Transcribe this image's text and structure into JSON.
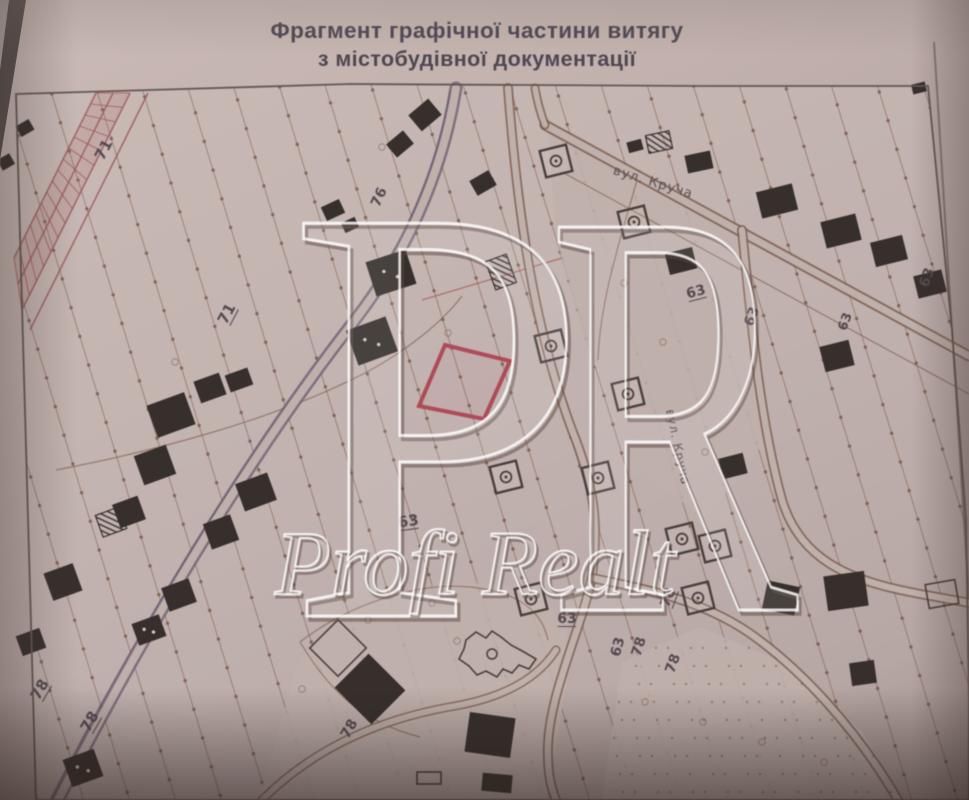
{
  "title": {
    "line1": "Фрагмент графічної частини витягу",
    "line2": "з містобудівної документації"
  },
  "watermark": {
    "letter_p": "P",
    "letter_r": "R",
    "name": "Profi Realt"
  },
  "colors": {
    "paper_map": "rgba(200,186,182,0.55)",
    "paper_solid": "#c0b0ac",
    "hatch_line": "rgba(125,88,70,0.55)",
    "hatch_dot": "rgba(100,64,48,0.6)",
    "boundary": "rgba(130,90,75,0.8)",
    "boundary_red": "rgba(168,82,80,0.85)",
    "road_edge": "#7a5a49",
    "road_main": "#6f5f74",
    "rail": "#a05a60",
    "rail_fill": "rgba(176,92,96,0.16)",
    "highlight": "#b34a58",
    "highlight_fill": "rgba(179,74,88,0.06)",
    "building": "#362f2b",
    "building_dot": "#d8ccc6",
    "symbol": "#4a3f3b",
    "label": "#554a52",
    "street": "#5b4f55",
    "frame": "#625854",
    "title": "#4d4753",
    "watermark_light": "rgba(255,255,255,0.82)",
    "watermark_dark": "rgba(92,72,64,0.5)",
    "watermark_fill": "rgba(240,236,238,0.10)",
    "dot_texture": "rgba(110,80,65,0.5)"
  },
  "map": {
    "frame": "16,94 350,84 700,86 928,86 952,330 966,520 969,700 969,800 36,800",
    "paper_edge": "M 934,42 C 948,240 958,420 969,600",
    "clear_regions": [
      "548,130 735,227 748,340 762,445 705,520 640,468 590,355 556,238",
      "258,800 300,658 362,602 452,582 540,587 572,642 560,722 546,800",
      "602,800 622,662 700,627 782,662 862,732 902,800"
    ],
    "rail_band": {
      "poly": "96,93 130,93 22,310 14,258",
      "lines": [
        "M 130,93 L 22,310",
        "M 96,93 L 14,258",
        "M 148,93 L 30,330",
        "M 113,93 L 18,284"
      ],
      "tick_a": [
        96,
        93,
        14,
        258
      ],
      "tick_b": [
        130,
        93,
        22,
        310
      ],
      "ticks": 15
    },
    "boundaries": [
      {
        "d": "M 56,470 C 160,450 270,420 355,378 C 400,356 440,325 462,296"
      },
      {
        "d": "M 562,172 C 700,247 832,320 969,394"
      },
      {
        "d": "M 422,300 L 562,258",
        "red": 1
      },
      {
        "d": "M 300,642 C 352,602 420,582 470,587 C 520,592 542,612 548,640"
      },
      {
        "d": "M 300,642 C 330,692 362,722 420,737"
      },
      {
        "d": "M 640,170 C 620,240 600,300 598,360"
      },
      {
        "d": "M 50,800 C 152,602 258,438 348,323 C 398,258 436,178 450,90",
        "main": 1
      },
      {
        "d": "M 934,42 C 948,240 958,420 969,600",
        "edge": 1
      }
    ],
    "roads": [
      {
        "d": "M 58,800 C 160,600 265,435 355,320 C 405,255 442,175 456,88",
        "w": 13,
        "iw": 8,
        "main": 1
      },
      {
        "d": "M 545,125 C 690,203 832,280 969,356",
        "w": 11,
        "iw": 7
      },
      {
        "d": "M 545,125 C 540,112 537,100 535,88",
        "w": 9,
        "iw": 5.5
      },
      {
        "d": "M 508,88 C 518,220 535,330 572,430 C 592,480 600,520 592,575 C 585,620 550,690 548,745 C 547,775 552,790 556,800",
        "w": 10,
        "iw": 6.5
      },
      {
        "d": "M 742,230 C 752,330 760,420 782,500 C 800,560 850,580 910,592 C 935,597 955,600 969,603",
        "w": 10,
        "iw": 6.5
      },
      {
        "d": "M 592,578 C 650,590 700,600 748,632 C 800,668 856,728 898,800",
        "w": 10,
        "iw": 6.5
      },
      {
        "d": "M 262,800 C 320,742 390,717 455,706 C 505,697 538,678 556,650",
        "w": 9,
        "iw": 6
      }
    ],
    "highlight_parcel": "445,345 510,361 484,419 419,406",
    "buildings": [
      [
        25,
        128,
        15,
        12,
        -30,
        0
      ],
      [
        6,
        162,
        14,
        12,
        -30,
        0
      ],
      [
        210,
        388,
        27,
        23,
        -20,
        0
      ],
      [
        239,
        380,
        24,
        18,
        -20,
        0
      ],
      [
        171,
        415,
        40,
        34,
        -20,
        0
      ],
      [
        155,
        465,
        34,
        31,
        -20,
        0
      ],
      [
        129,
        512,
        27,
        25,
        -20,
        0
      ],
      [
        221,
        532,
        29,
        27,
        -20,
        0
      ],
      [
        256,
        492,
        34,
        29,
        -20,
        0
      ],
      [
        63,
        582,
        31,
        29,
        -20,
        0
      ],
      [
        179,
        595,
        29,
        25,
        -20,
        0
      ],
      [
        31,
        642,
        25,
        21,
        -20,
        0
      ],
      [
        149,
        630,
        29,
        23,
        -20,
        2
      ],
      [
        83,
        768,
        33,
        29,
        -20,
        2
      ],
      [
        425,
        115,
        26,
        21,
        -40,
        0
      ],
      [
        400,
        144,
        22,
        17,
        -40,
        0
      ],
      [
        483,
        183,
        22,
        17,
        -30,
        0
      ],
      [
        333,
        210,
        20,
        15,
        -25,
        0
      ],
      [
        350,
        225,
        15,
        11,
        -25,
        0
      ],
      [
        391,
        273,
        42,
        36,
        -18,
        2
      ],
      [
        372,
        341,
        42,
        37,
        -20,
        2
      ],
      [
        635,
        146,
        15,
        11,
        -15,
        0
      ],
      [
        699,
        162,
        26,
        18,
        -12,
        0
      ],
      [
        777,
        201,
        37,
        27,
        -14,
        0
      ],
      [
        841,
        231,
        36,
        27,
        -14,
        0
      ],
      [
        889,
        251,
        33,
        25,
        -14,
        0
      ],
      [
        930,
        284,
        29,
        23,
        -14,
        0
      ],
      [
        837,
        356,
        30,
        26,
        -14,
        0
      ],
      [
        681,
        261,
        28,
        22,
        -14,
        0
      ],
      [
        919,
        88,
        14,
        10,
        -14,
        0
      ],
      [
        733,
        466,
        25,
        21,
        -14,
        0
      ],
      [
        781,
        598,
        33,
        29,
        12,
        0
      ],
      [
        846,
        591,
        41,
        35,
        -8,
        0
      ],
      [
        863,
        673,
        25,
        23,
        -8,
        0
      ],
      [
        370,
        689,
        52,
        48,
        45,
        0
      ],
      [
        490,
        735,
        46,
        40,
        8,
        0
      ],
      [
        497,
        783,
        30,
        18,
        5,
        0
      ]
    ],
    "hatched_buildings": [
      [
        501,
        272,
        22,
        30,
        -20
      ],
      [
        659,
        142,
        24,
        18,
        -12
      ],
      [
        111,
        522,
        25,
        23,
        -20
      ]
    ],
    "outline_buildings": [
      [
        942,
        594,
        30,
        24,
        -10
      ],
      [
        429,
        778,
        24,
        12,
        0
      ],
      [
        338,
        648,
        40,
        40,
        45
      ]
    ],
    "symbols": [
      [
        556,
        161
      ],
      [
        634,
        222
      ],
      [
        551,
        346
      ],
      [
        628,
        394
      ],
      [
        506,
        477
      ],
      [
        598,
        478
      ],
      [
        682,
        539
      ],
      [
        715,
        546
      ],
      [
        698,
        598
      ],
      [
        531,
        599
      ]
    ],
    "church": {
      "poly": "466,640 476,632 486,638 492,631 501,637 511,645 524,652 536,659 529,669 519,665 512,673 503,669 497,677 486,671 477,675 469,666 459,659 464,649",
      "cx": 492,
      "cy": 654,
      "r": 5
    },
    "small_circles": [
      [
        382,
        147
      ],
      [
        368,
        620
      ],
      [
        432,
        603
      ],
      [
        457,
        641
      ],
      [
        302,
        689
      ],
      [
        624,
        283
      ],
      [
        663,
        342
      ],
      [
        705,
        452
      ],
      [
        645,
        702
      ],
      [
        703,
        722
      ],
      [
        762,
        742
      ],
      [
        824,
        762
      ],
      [
        448,
        333
      ],
      [
        175,
        362
      ]
    ],
    "dots_poly": [
      [
        602,
        800
      ],
      [
        622,
        662
      ],
      [
        700,
        627
      ],
      [
        782,
        662
      ],
      [
        862,
        732
      ],
      [
        902,
        800
      ]
    ],
    "labels": [
      {
        "t": "71",
        "x": 108,
        "y": 152,
        "r": -62,
        "s": 15,
        "u": 0
      },
      {
        "t": "71",
        "x": 231,
        "y": 316,
        "r": -62,
        "s": 15,
        "u": 1
      },
      {
        "t": "76",
        "x": 383,
        "y": 199,
        "r": -65,
        "s": 14,
        "u": 0
      },
      {
        "t": "78",
        "x": 44,
        "y": 692,
        "r": -60,
        "s": 15,
        "u": 1
      },
      {
        "t": "78",
        "x": 94,
        "y": 724,
        "r": -60,
        "s": 15,
        "u": 1
      },
      {
        "t": "63",
        "x": 409,
        "y": 526,
        "r": -8,
        "s": 15,
        "u": 1
      },
      {
        "t": "63",
        "x": 697,
        "y": 296,
        "r": -15,
        "s": 14,
        "u": 1
      },
      {
        "t": "63",
        "x": 756,
        "y": 318,
        "r": -70,
        "s": 14,
        "u": 0
      },
      {
        "t": "63",
        "x": 567,
        "y": 623,
        "r": 0,
        "s": 14,
        "u": 1
      },
      {
        "t": "63",
        "x": 622,
        "y": 648,
        "r": -75,
        "s": 14,
        "u": 0
      },
      {
        "t": "78",
        "x": 643,
        "y": 648,
        "r": -72,
        "s": 14,
        "u": 0
      },
      {
        "t": "78",
        "x": 677,
        "y": 665,
        "r": -70,
        "s": 14,
        "u": 0
      },
      {
        "t": "78",
        "x": 672,
        "y": 599,
        "r": -70,
        "s": 14,
        "u": 1
      },
      {
        "t": "63",
        "x": 931,
        "y": 279,
        "r": -70,
        "s": 14,
        "u": 0
      },
      {
        "t": "63",
        "x": 849,
        "y": 323,
        "r": -70,
        "s": 13,
        "u": 0
      },
      {
        "t": "78",
        "x": 353,
        "y": 731,
        "r": -60,
        "s": 14,
        "u": 0
      }
    ],
    "street_labels": [
      {
        "t": "вул. Круча",
        "x": 652,
        "y": 186,
        "r": 17,
        "s": 13
      },
      {
        "t": "вул. Круча",
        "x": 674,
        "y": 448,
        "r": 78,
        "s": 12
      }
    ]
  }
}
